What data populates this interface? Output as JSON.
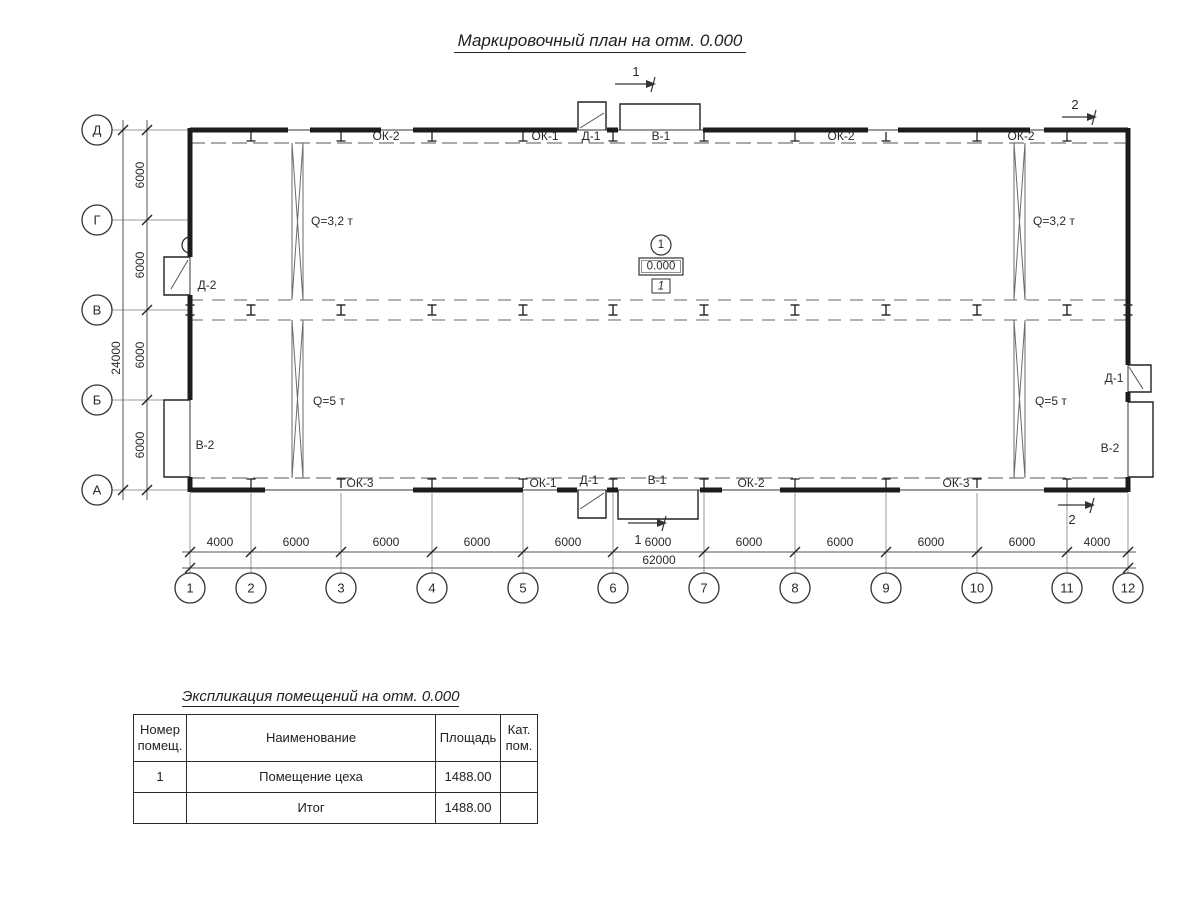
{
  "title": "Маркировочный план на отм. 0.000",
  "plan": {
    "axis_rows": [
      "Д",
      "Г",
      "В",
      "Б",
      "А"
    ],
    "axis_cols": [
      "1",
      "2",
      "3",
      "4",
      "5",
      "6",
      "7",
      "8",
      "9",
      "10",
      "11",
      "12"
    ],
    "dim_left_segments": [
      "6000",
      "6000",
      "6000",
      "6000"
    ],
    "dim_left_total": "24000",
    "dim_bottom_segments": [
      "4000",
      "6000",
      "6000",
      "6000",
      "6000",
      "6000",
      "6000",
      "6000",
      "6000",
      "6000",
      "4000"
    ],
    "dim_bottom_total": "62000",
    "top_wall_labels": [
      "ОК-2",
      "ОК-1",
      "Д-1",
      "В-1",
      "ОК-2",
      "ОК-2"
    ],
    "bottom_wall_labels": [
      "ОК-3",
      "ОК-1",
      "Д-1",
      "В-1",
      "ОК-2",
      "ОК-3"
    ],
    "left_wall_labels": [
      "Д-2",
      "В-2"
    ],
    "right_wall_labels": [
      "Д-1",
      "В-2"
    ],
    "crane_upper": "Q=3,2 т",
    "crane_lower": "Q=5 т",
    "room_marker": {
      "number": "1",
      "elevation": "0.000",
      "room": "1"
    },
    "section_mark_1": "1",
    "section_mark_2": "2"
  },
  "table": {
    "title": "Экспликация помещений на отм. 0.000",
    "headers": [
      "Номер помещ.",
      "Наименование",
      "Площадь",
      "Кат. пом."
    ],
    "rows": [
      {
        "num": "1",
        "name": "Помещение цеха",
        "area": "1488.00",
        "cat": ""
      },
      {
        "num": "",
        "name": "Итог",
        "area": "1488.00",
        "cat": ""
      }
    ]
  }
}
